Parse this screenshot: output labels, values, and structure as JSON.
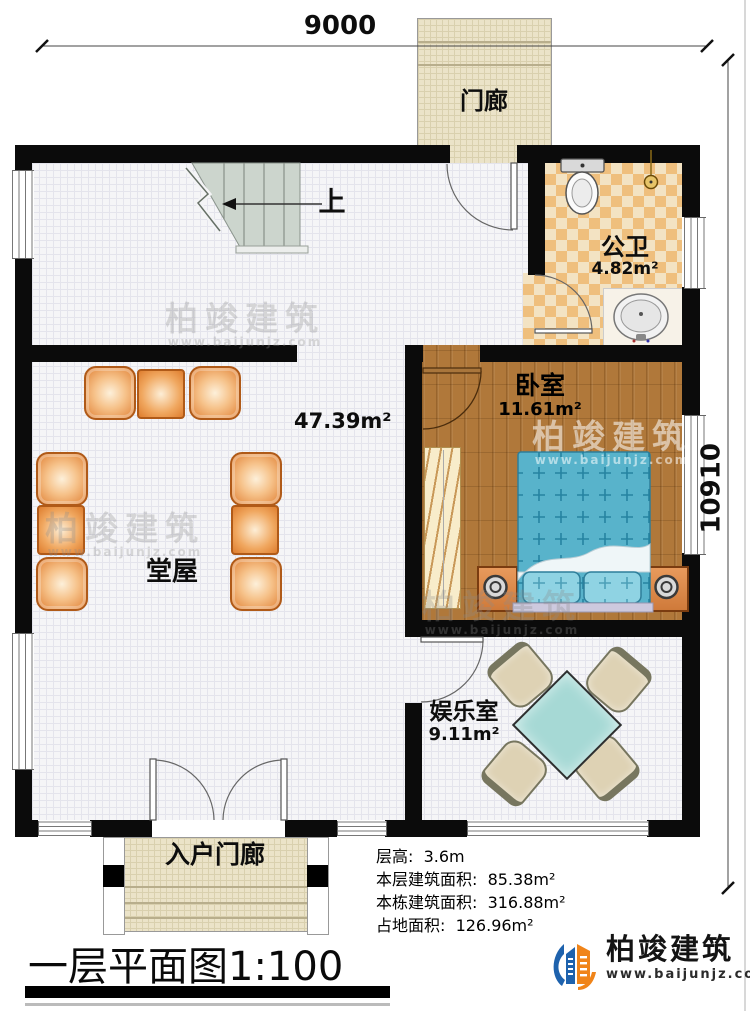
{
  "dimensions": {
    "width_mm": "9000",
    "height_mm": "10910"
  },
  "rooms": {
    "porch": {
      "name": "门廊"
    },
    "bathroom": {
      "name": "公卫",
      "area": "4.82m²"
    },
    "bedroom": {
      "name": "卧室",
      "area": "11.61m²"
    },
    "hall": {
      "name": "堂屋",
      "area": "47.39m²"
    },
    "entertainment": {
      "name": "娱乐室",
      "area": "9.11m²"
    },
    "entrance_porch": {
      "name": "入户门廊"
    },
    "stairs": {
      "direction_label": "上"
    }
  },
  "info_block": {
    "floor_height": "层高:  3.6m",
    "floor_area": "本层建筑面积:  85.38m²",
    "building_area": "本栋建筑面积:  316.88m²",
    "footprint_area": "占地面积:  126.96m²"
  },
  "title_block": {
    "title": "一层平面图",
    "scale": "1:100"
  },
  "brand": {
    "name": "柏竣建筑",
    "website": "www.baijunjz.com"
  },
  "watermark": {
    "name": "柏竣建筑",
    "website": "www.baijunjz.com"
  },
  "colors": {
    "wall": "#0b0b0b",
    "wood_floor": "#b0783a",
    "bath_tile": "#efbf7d",
    "bed_blue": "#58b3cb",
    "furniture_orange": "#e08034",
    "game_table_teal": "#a6d9d5",
    "brand_blue": "#1e62ad",
    "brand_orange": "#f08419"
  }
}
